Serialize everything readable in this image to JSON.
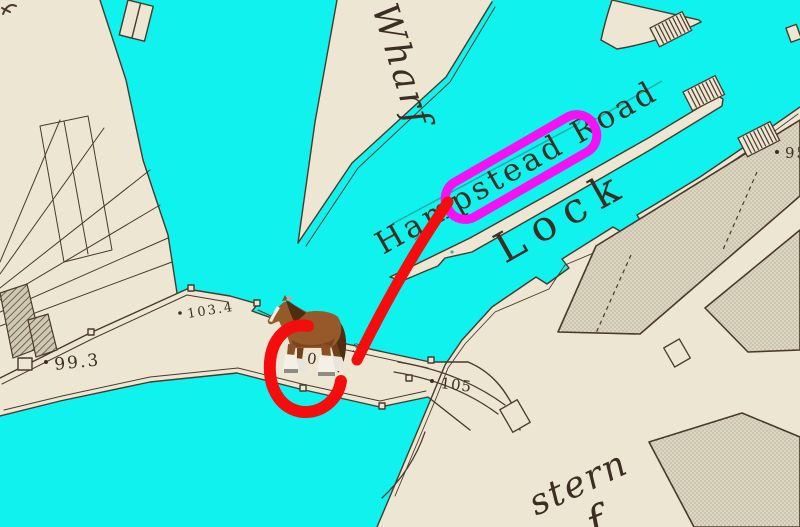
{
  "map": {
    "place_labels": {
      "wharf": "Wharf",
      "hampstead_road": "Hampstead Road",
      "lock": "Lock",
      "stern": "stern",
      "partial_word": "f"
    },
    "spot_heights": {
      "h1034": "103.4",
      "h993": "99.3",
      "h10": "10",
      "h3": "3",
      "h105": "105",
      "h95": "95"
    },
    "colors": {
      "water": "#10F2EE",
      "paper": "#EDE6D2",
      "ink": "#4A392B"
    }
  },
  "annotations": {
    "highlight_box_color": "#F411F4",
    "route_color": "#F50D0D",
    "marker": "horse"
  }
}
